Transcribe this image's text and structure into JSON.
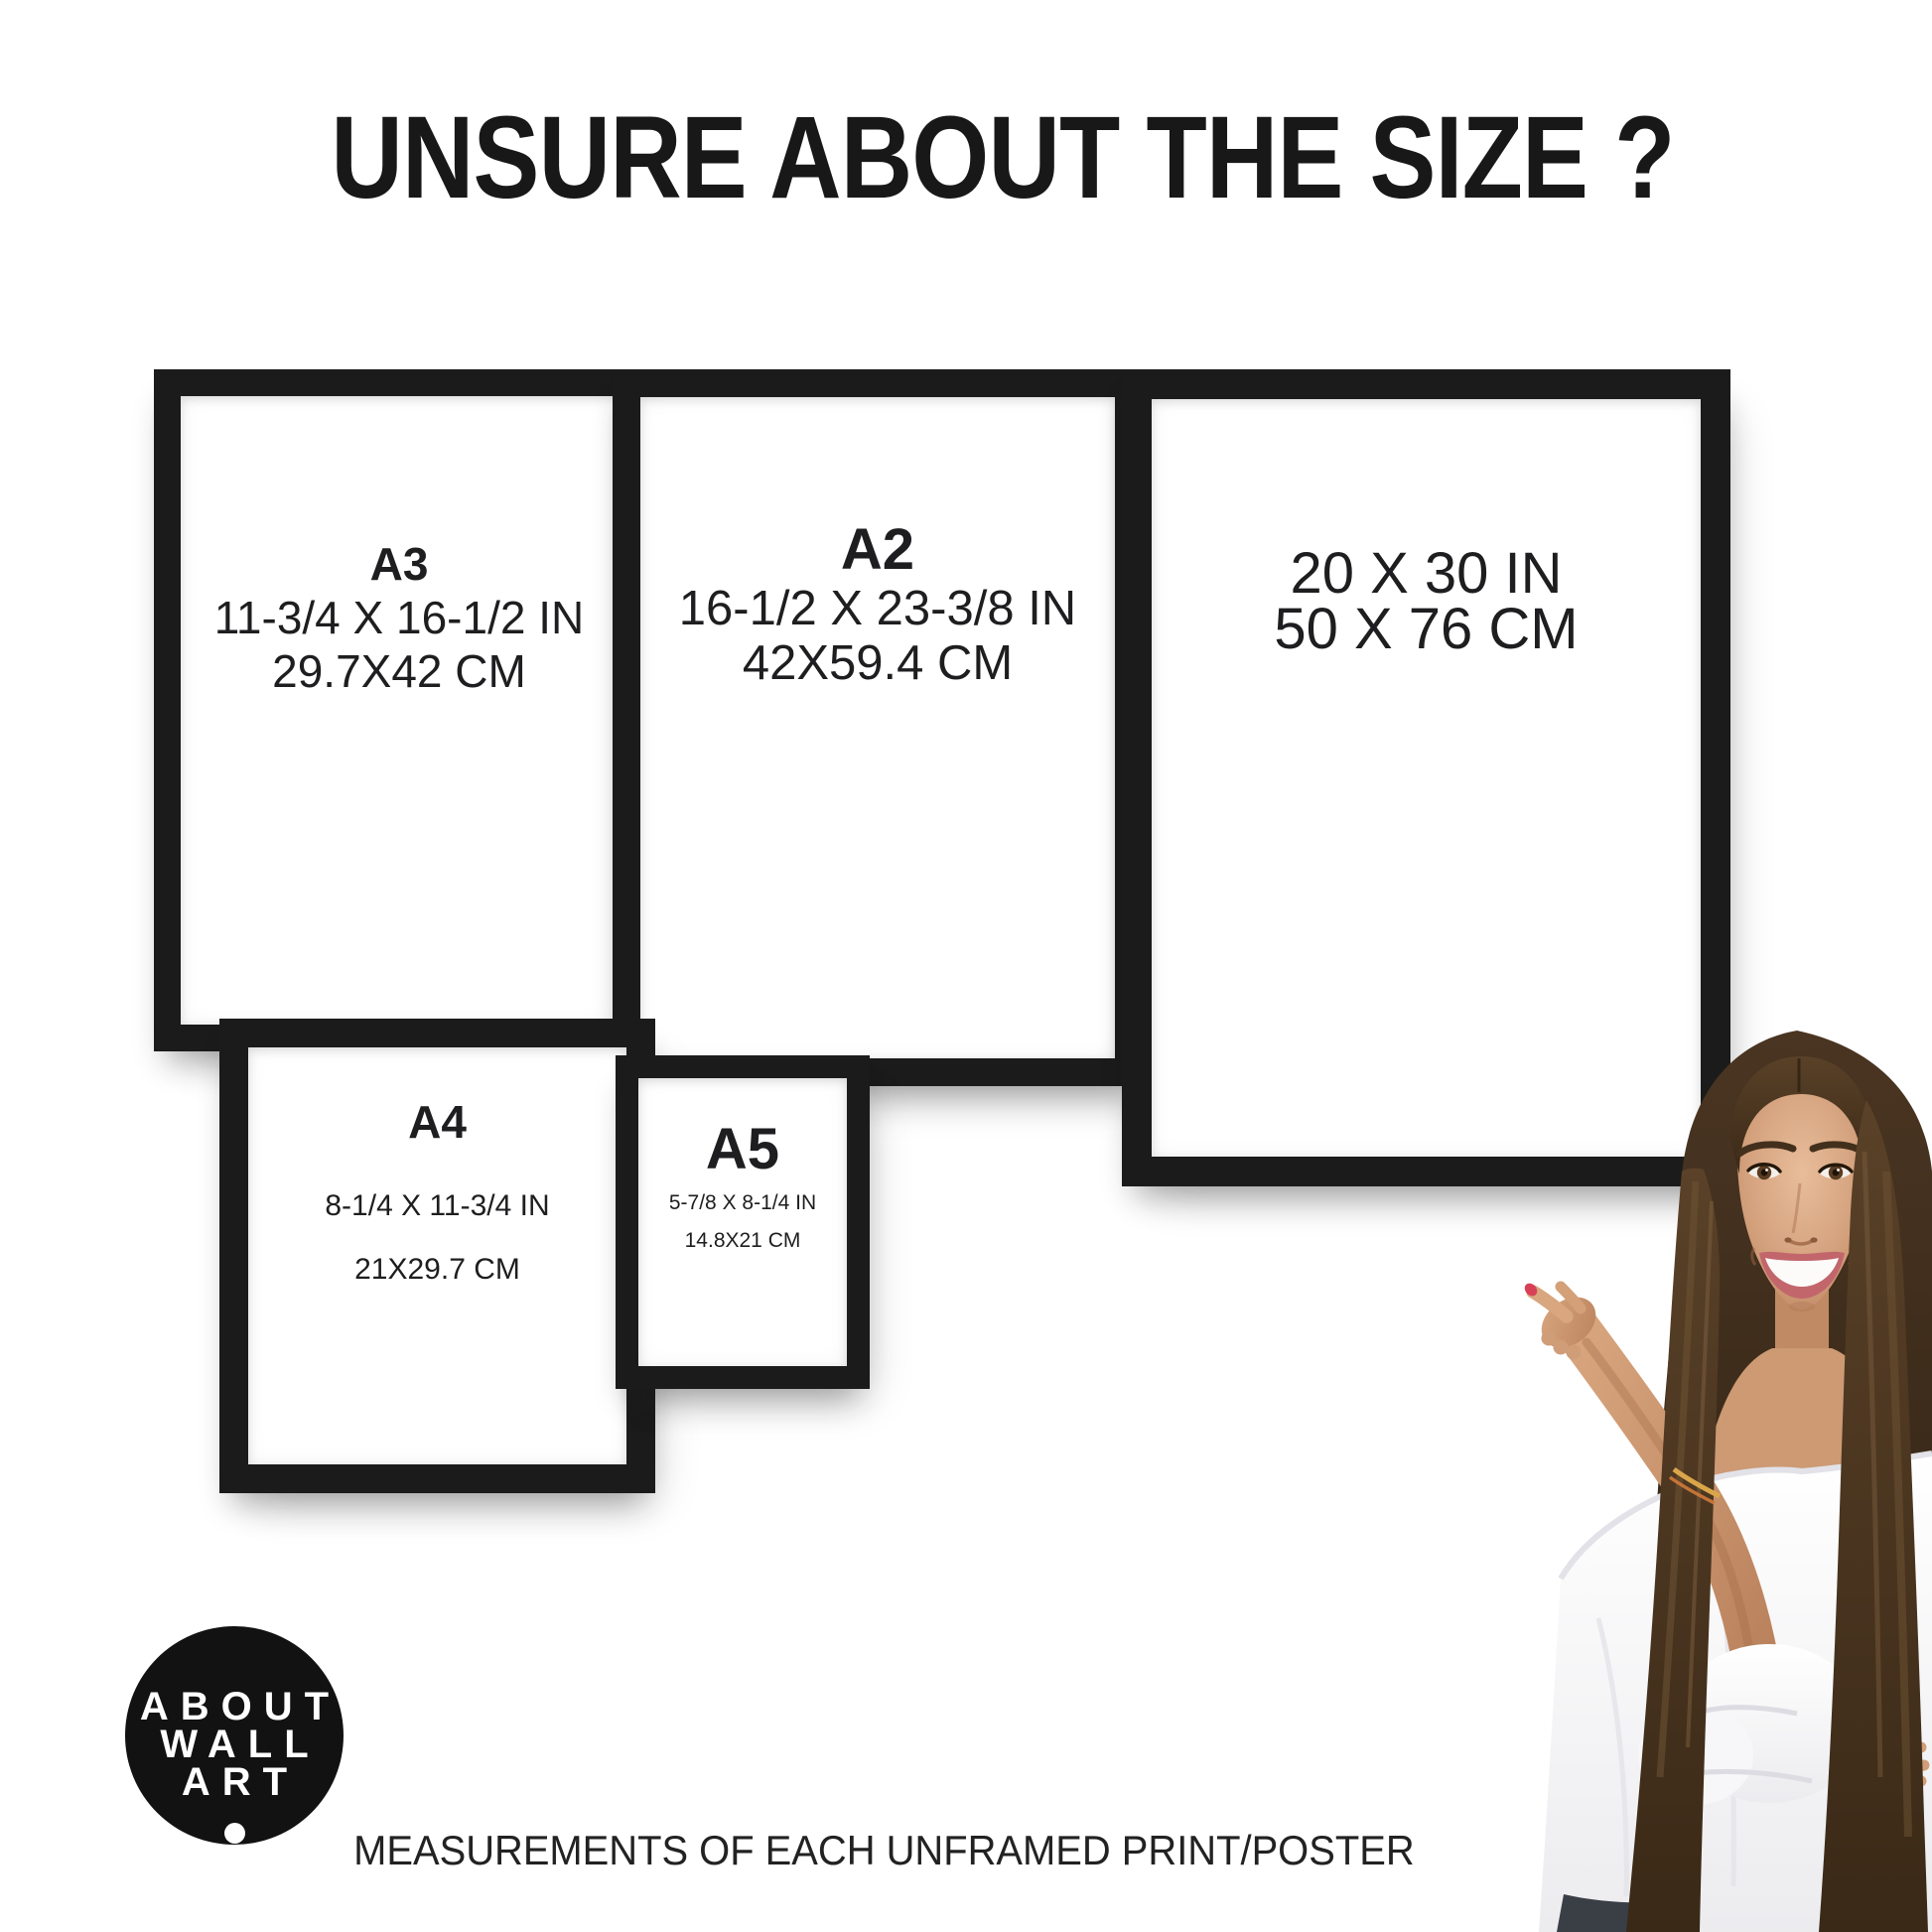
{
  "title": "UNSURE ABOUT THE SIZE ?",
  "caption": "MEASUREMENTS OF EACH UNFRAMED PRINT/POSTER",
  "logo": {
    "line1": "ABOUT",
    "line2": "WALL",
    "line3": "ART"
  },
  "frames": [
    {
      "id": "a3",
      "label": "A3",
      "inches": "11-3/4 X 16-1/2 IN",
      "cm": "29.7X42 CM"
    },
    {
      "id": "a2",
      "label": "A2",
      "inches": "16-1/2 X 23-3/8 IN",
      "cm": "42X59.4 CM"
    },
    {
      "id": "20x30",
      "label": "",
      "inches": "20 X 30 IN",
      "cm": "50 X 76 CM"
    },
    {
      "id": "a4",
      "label": "A4",
      "inches": "8-1/4 X 11-3/4 IN",
      "cm": "21X29.7 CM"
    },
    {
      "id": "a5",
      "label": "A5",
      "inches": "5-7/8 X 8-1/4 IN",
      "cm": "14.8X21 CM"
    }
  ],
  "colors": {
    "frame_black": "#1b1b1b",
    "text": "#1e1e20",
    "logo_background": "#121212",
    "logo_text": "#ffffff",
    "nail_polish": "#d84058",
    "background": "#ffffff"
  }
}
